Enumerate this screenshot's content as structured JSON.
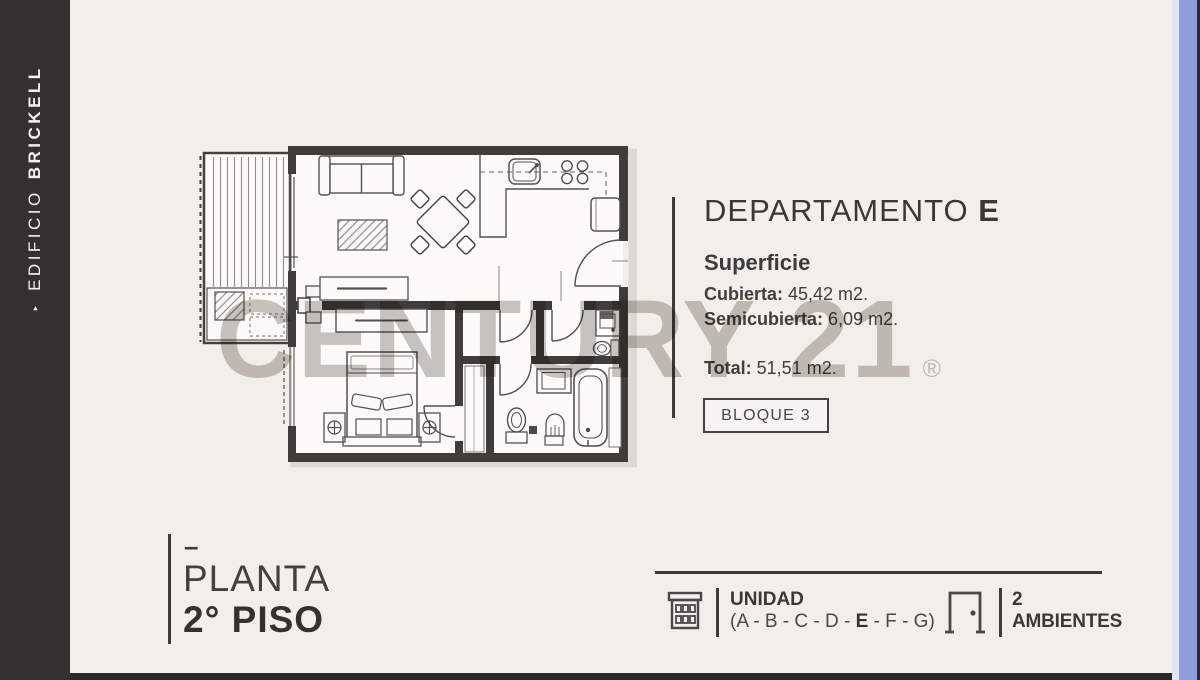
{
  "sidebar": {
    "arrow": "‣",
    "building_prefix": "EDIFICIO",
    "building_name": "BRICKELL"
  },
  "watermark": {
    "brand": "CENTURY 21",
    "registered": "®"
  },
  "apartment": {
    "title_label": "DEPARTAMENTO",
    "title_unit": "E",
    "surface_heading": "Superficie",
    "covered_label": "Cubierta:",
    "covered_value": " 45,42 m2.",
    "semicovered_label": "Semicubierta:",
    "semicovered_value": " 6,09 m2.",
    "total_label": "Total:",
    "total_value": " 51,51 m2.",
    "block_badge": "BLOQUE 3"
  },
  "floor": {
    "dash": "–",
    "label": "PLANTA",
    "value": "2° PISO"
  },
  "footer": {
    "unit_heading": "UNIDAD",
    "unit_options_head": "(A - B - C - D - ",
    "unit_selected": "E",
    "unit_options_tail": " - F - G)",
    "rooms_count": "2",
    "rooms_label": "AMBIENTES"
  },
  "colors": {
    "sidebar": "#33302d",
    "background": "#f2eeea",
    "ink": "#3e3c3a",
    "walls": "#3f3c39",
    "watermark": "#c9c5c1",
    "accent_stripe": "#919cdd",
    "accent_stripe_light": "#dfe4f7",
    "bottom_bar": "#2b2927"
  }
}
